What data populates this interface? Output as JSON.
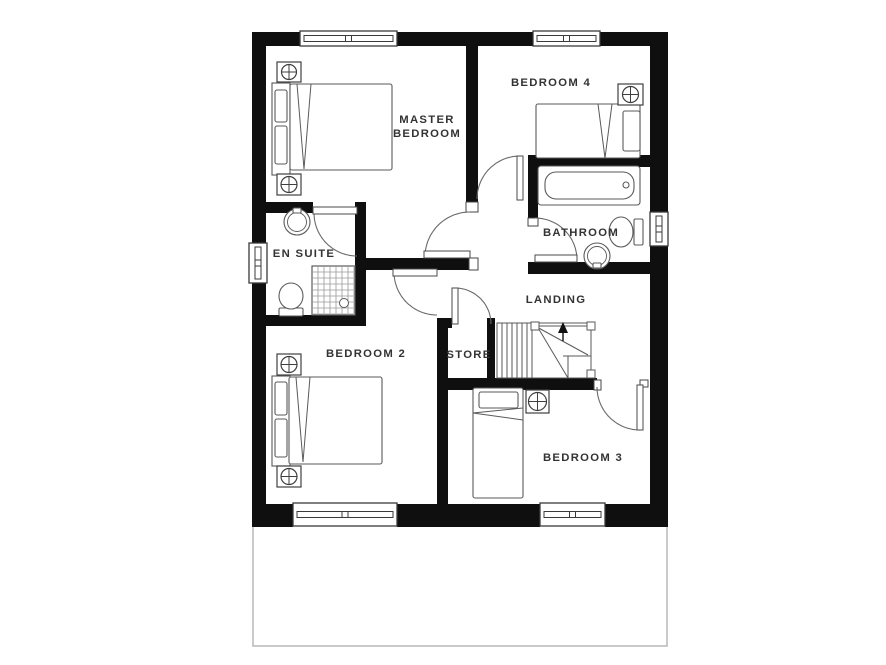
{
  "canvas": {
    "width": 886,
    "height": 665,
    "background": "#ffffff"
  },
  "colors": {
    "wall": "#0f0f0f",
    "furniture_line": "#5a5a5a",
    "door_line": "#6a6a6a",
    "window_line": "#3a3a3a",
    "label_text": "#333333",
    "ground_outline": "#b8b8b8",
    "shower_grid": "#9a9a9a",
    "arrow": "#111111"
  },
  "rooms": [
    {
      "id": "master-bedroom",
      "lines": [
        "MASTER",
        "BEDROOM"
      ],
      "x": 427,
      "y": 123,
      "lh": 14
    },
    {
      "id": "bedroom-4",
      "lines": [
        "BEDROOM 4"
      ],
      "x": 551,
      "y": 86,
      "lh": 14
    },
    {
      "id": "bathroom",
      "lines": [
        "BATHROOM"
      ],
      "x": 581,
      "y": 236,
      "lh": 14
    },
    {
      "id": "en-suite",
      "lines": [
        "EN SUITE"
      ],
      "x": 304,
      "y": 257,
      "lh": 14
    },
    {
      "id": "landing",
      "lines": [
        "LANDING"
      ],
      "x": 556,
      "y": 303,
      "lh": 14
    },
    {
      "id": "store",
      "lines": [
        "STORE"
      ],
      "x": 469,
      "y": 358,
      "lh": 14
    },
    {
      "id": "bedroom-2",
      "lines": [
        "BEDROOM 2"
      ],
      "x": 366,
      "y": 357,
      "lh": 14
    },
    {
      "id": "bedroom-3",
      "lines": [
        "BEDROOM 3"
      ],
      "x": 583,
      "y": 461,
      "lh": 14
    }
  ],
  "floorplan": {
    "ground_outline": [
      253,
      524,
      414,
      122
    ],
    "walls": [
      [
        252,
        32,
        48,
        14
      ],
      [
        397,
        32,
        136,
        14
      ],
      [
        600,
        32,
        68,
        14
      ],
      [
        252,
        504,
        41,
        23
      ],
      [
        397,
        504,
        143,
        23
      ],
      [
        605,
        504,
        63,
        23
      ],
      [
        252,
        32,
        14,
        211
      ],
      [
        252,
        283,
        14,
        244
      ],
      [
        650,
        32,
        18,
        180
      ],
      [
        650,
        246,
        18,
        281
      ],
      [
        466,
        46,
        12,
        156
      ],
      [
        528,
        155,
        122,
        12
      ],
      [
        528,
        155,
        10,
        63
      ],
      [
        528,
        262,
        122,
        12
      ],
      [
        266,
        202,
        47,
        11
      ],
      [
        355,
        202,
        11,
        124
      ],
      [
        266,
        315,
        100,
        11
      ],
      [
        362,
        258,
        107,
        12
      ],
      [
        437,
        318,
        11,
        190
      ],
      [
        437,
        318,
        15,
        10
      ],
      [
        487,
        318,
        8,
        70
      ],
      [
        437,
        378,
        160,
        12
      ]
    ],
    "jambs": [
      [
        466,
        202,
        12,
        10
      ],
      [
        469,
        258,
        9,
        12
      ],
      [
        528,
        218,
        10,
        8
      ],
      [
        594,
        380,
        7,
        10
      ],
      [
        640,
        380,
        8,
        7
      ]
    ],
    "windows": [
      {
        "id": "master-bedroom-window",
        "r": [
          300,
          31,
          97,
          15
        ],
        "o": "h"
      },
      {
        "id": "bedroom-4-window",
        "r": [
          533,
          31,
          67,
          15
        ],
        "o": "h"
      },
      {
        "id": "bedroom-2-window",
        "r": [
          293,
          503,
          104,
          23
        ],
        "o": "h"
      },
      {
        "id": "bedroom-3-window",
        "r": [
          540,
          503,
          65,
          23
        ],
        "o": "h"
      },
      {
        "id": "en-suite-window",
        "r": [
          249,
          243,
          18,
          40
        ],
        "o": "v"
      },
      {
        "id": "bathroom-window",
        "r": [
          650,
          212,
          18,
          34
        ],
        "o": "v"
      }
    ],
    "doors": [
      {
        "id": "master-bedroom-door",
        "cx": 470,
        "cy": 257,
        "r": 45,
        "a1": 180,
        "a2": 270,
        "leaf": [
          424,
          251,
          46,
          7
        ]
      },
      {
        "id": "bedroom-4-door",
        "cx": 520,
        "cy": 199,
        "r": 43,
        "a1": 180,
        "a2": 270,
        "leaf": [
          517,
          156,
          6,
          44
        ]
      },
      {
        "id": "en-suite-door",
        "cx": 357,
        "cy": 213,
        "r": 43,
        "a1": 180,
        "a2": 90,
        "leaf": [
          313,
          207,
          44,
          7
        ]
      },
      {
        "id": "bathroom-door",
        "cx": 535,
        "cy": 260,
        "r": 42,
        "a1": 270,
        "a2": 360,
        "leaf": [
          535,
          255,
          42,
          7
        ]
      },
      {
        "id": "bedroom-2-door",
        "cx": 437,
        "cy": 272,
        "r": 43,
        "a1": 90,
        "a2": 180,
        "leaf": [
          393,
          269,
          44,
          7
        ]
      },
      {
        "id": "store-door",
        "cx": 455,
        "cy": 324,
        "r": 36,
        "a1": 270,
        "a2": 360,
        "leaf": [
          452,
          288,
          6,
          36
        ]
      },
      {
        "id": "bedroom-3-door",
        "cx": 640,
        "cy": 387,
        "r": 43,
        "a1": 90,
        "a2": 180,
        "leaf": [
          637,
          385,
          6,
          45
        ]
      }
    ],
    "stairs": {
      "box": [
        497,
        323,
        94,
        55
      ],
      "treads_x": [
        502,
        507,
        512,
        517,
        522,
        527,
        532
      ],
      "lines": [
        [
          531,
          326,
          591,
          326
        ],
        [
          591,
          326,
          591,
          374
        ],
        [
          535,
          326,
          588,
          355
        ],
        [
          537,
          326,
          568,
          378
        ],
        [
          563,
          356,
          591,
          356
        ],
        [
          568,
          356,
          568,
          378
        ]
      ],
      "newels": [
        [
          531,
          322,
          8,
          8
        ],
        [
          587,
          322,
          8,
          8
        ],
        [
          587,
          370,
          8,
          8
        ]
      ],
      "arrow": {
        "stem": [
          563,
          341,
          563,
          330
        ],
        "head": [
          [
            563,
            322
          ],
          [
            558,
            333
          ],
          [
            568,
            333
          ]
        ]
      }
    },
    "lights": [
      [
        277,
        62,
        24,
        20
      ],
      [
        277,
        174,
        24,
        21
      ],
      [
        277,
        354,
        24,
        21
      ],
      [
        277,
        466,
        24,
        21
      ],
      [
        618,
        84,
        25,
        21
      ],
      [
        526,
        390,
        23,
        23
      ]
    ],
    "beds": [
      {
        "id": "master-bed",
        "headboard": [
          272,
          83,
          18,
          92
        ],
        "pillows": [
          [
            275,
            90,
            12,
            32
          ],
          [
            275,
            126,
            12,
            38
          ]
        ],
        "mattress": [
          290,
          84,
          102,
          86
        ],
        "fold": [
          [
            297,
            84,
            304,
            169
          ],
          [
            311,
            84,
            304,
            169
          ]
        ]
      },
      {
        "id": "bedroom-2-bed",
        "headboard": [
          272,
          376,
          18,
          90
        ],
        "pillows": [
          [
            275,
            382,
            12,
            33
          ],
          [
            275,
            419,
            12,
            38
          ]
        ],
        "mattress": [
          289,
          377,
          93,
          87
        ],
        "fold": [
          [
            296,
            377,
            303,
            462
          ],
          [
            310,
            377,
            303,
            462
          ]
        ]
      },
      {
        "id": "bedroom-4-bed",
        "pillows": [
          [
            623,
            111,
            17,
            40
          ]
        ],
        "mattress": [
          536,
          104,
          104,
          54
        ],
        "fold": [
          [
            612,
            104,
            605,
            158
          ],
          [
            598,
            104,
            605,
            158
          ]
        ]
      },
      {
        "id": "bedroom-3-bed",
        "pillows": [
          [
            479,
            392,
            39,
            16
          ]
        ],
        "mattress": [
          473,
          388,
          50,
          110
        ],
        "fold": [
          [
            473,
            413,
            523,
            408
          ],
          [
            473,
            413,
            523,
            420
          ]
        ]
      }
    ],
    "bathtub": {
      "outer": [
        538,
        166,
        102,
        39
      ],
      "inner": [
        545,
        172,
        89,
        27
      ],
      "drain": [
        626,
        185,
        3
      ]
    },
    "toilets": [
      {
        "id": "en-suite-toilet",
        "bowl": [
          291,
          296,
          12,
          13
        ],
        "cistern": [
          279,
          308,
          24,
          8
        ]
      },
      {
        "id": "bathroom-toilet",
        "bowl": [
          621,
          232,
          12,
          15
        ],
        "cistern": [
          634,
          219,
          9,
          26
        ]
      }
    ],
    "sinks": [
      {
        "id": "en-suite-sink",
        "cx": 297,
        "cy": 222,
        "r": 13,
        "ri": 9.5,
        "tap": [
          293,
          208,
          8,
          5
        ]
      },
      {
        "id": "bathroom-sink",
        "cx": 597,
        "cy": 256,
        "r": 13,
        "ri": 9.5,
        "tap": [
          593,
          263,
          8,
          5
        ]
      }
    ],
    "shower": {
      "rect": [
        312,
        266,
        43,
        49
      ],
      "grid": 6,
      "drain": [
        344,
        303,
        4.5
      ]
    }
  }
}
